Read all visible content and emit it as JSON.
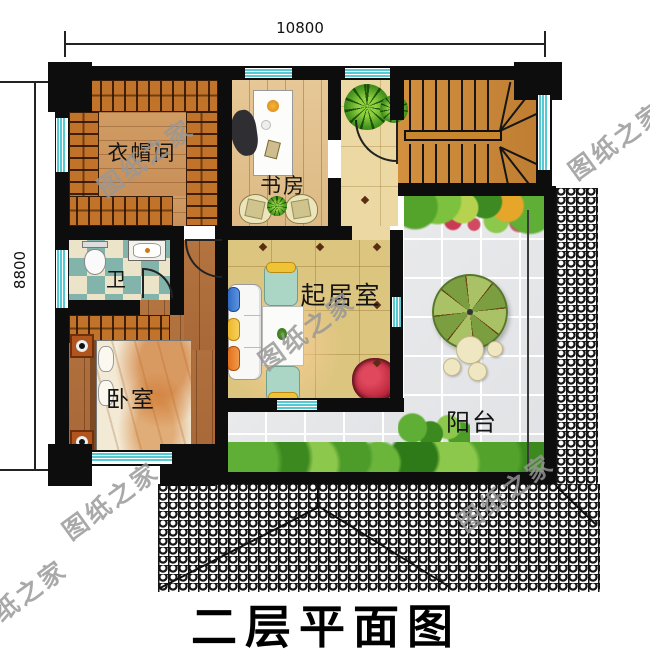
{
  "title": "二层平面图",
  "dimensions": {
    "top_width": "10800",
    "left_height": "8800"
  },
  "rooms": {
    "cloakroom": "衣帽间",
    "study": "书房",
    "bathroom": "卫",
    "living_room": "起居室",
    "bedroom": "卧室",
    "balcony": "阳台"
  },
  "watermark": "图纸之家",
  "colors": {
    "wall": "#0d0d0d",
    "window": "#57c9d2",
    "wardrobe_wood": "#c2732a",
    "stair_wood": "#cf8a3d",
    "bedroom_wood": "#ab6c38",
    "living_floor": "#dcc57f",
    "hall_tile": "#ecd8a2",
    "balcony_tile": "#e6e7e9",
    "bath_tile_teal": "#82b4ab",
    "bath_tile_cream": "#ece4c9",
    "flower_red": "#c03040",
    "parasol_green": "#9ab84d"
  }
}
